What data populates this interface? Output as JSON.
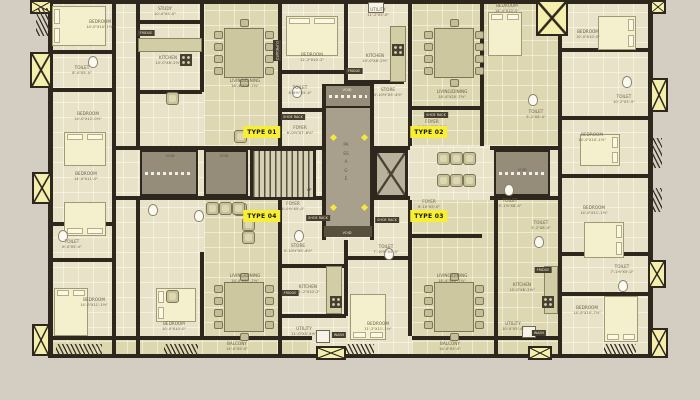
{
  "colors": {
    "background": "#d4cec2",
    "wall": "#2e271e",
    "floor": "#e8e3c8",
    "living_floor": "#ddd8b2",
    "passage": "#a89f8c",
    "void": "#958c7a",
    "highlight_label": "#f7ef35",
    "window_fill": "#f5efad",
    "furniture": "#c7c199",
    "bed": "#f4f0cd",
    "label_text": "#6d6049"
  },
  "icons": {
    "window_cross": "window-x-icon",
    "lift_cross": "lift-x-icon",
    "stairs": "staircase-icon",
    "marker": "diamond-marker-icon"
  },
  "unit_labels": [
    {
      "text": "TYPE 01",
      "x": 262,
      "y": 126
    },
    {
      "text": "TYPE 02",
      "x": 429,
      "y": 126
    },
    {
      "text": "TYPE 03",
      "x": 429,
      "y": 210
    },
    {
      "text": "TYPE 04",
      "x": 262,
      "y": 210
    }
  ],
  "core": {
    "passage": "PASSAGE",
    "lift": "LIFT",
    "up": "UP",
    "void": "VOID"
  },
  "void_labels": [
    {
      "x": 170,
      "y": 154,
      "light": false
    },
    {
      "x": 224,
      "y": 154,
      "light": false
    },
    {
      "x": 522,
      "y": 168,
      "light": false
    },
    {
      "x": 347,
      "y": 88,
      "light": true
    },
    {
      "x": 347,
      "y": 231,
      "light": true
    }
  ],
  "room_labels": [
    {
      "name": "BEDROOM",
      "dims": "14'-0\"X10'-1½\"",
      "x": 100,
      "y": 20
    },
    {
      "name": "TOILET",
      "dims": "8'-0\"X5'-0\"",
      "x": 82,
      "y": 66
    },
    {
      "name": "BEDROOM",
      "dims": "14'-0\"X12'-0½\"",
      "x": 88,
      "y": 112
    },
    {
      "name": "BEDROOM",
      "dims": "14'-0\"X11'-0\"",
      "x": 86,
      "y": 172
    },
    {
      "name": "TOILET",
      "dims": "8'-0\"X5'-0\"",
      "x": 72,
      "y": 240
    },
    {
      "name": "BEDROOM",
      "dims": "14'-0\"X11'-1½\"",
      "x": 94,
      "y": 298
    },
    {
      "name": "BEDROOM",
      "dims": "10'-0\"X10'-0\"",
      "x": 174,
      "y": 322
    },
    {
      "name": "STUDY",
      "dims": "10'-0\"X5'-0\"",
      "x": 165,
      "y": 7
    },
    {
      "name": "KITCHEN",
      "dims": "10'-0\"X8'-2½\"",
      "x": 168,
      "y": 56
    },
    {
      "name": "LIVING/DINING",
      "dims": "18'-4\"X20'-7½\"",
      "x": 245,
      "y": 79
    },
    {
      "name": "BEDROOM",
      "dims": "11'-2\"X10'-2\"",
      "x": 312,
      "y": 53
    },
    {
      "name": "TOILET",
      "dims": "8'-6½\"X5'-4\"",
      "x": 300,
      "y": 86
    },
    {
      "name": "FOYER",
      "dims": "6'-0½\"X7'-6½\"",
      "x": 300,
      "y": 126
    },
    {
      "name": "UTILITY",
      "dims": "11'-2\"X5'-0\"",
      "x": 378,
      "y": 8
    },
    {
      "name": "KITCHEN",
      "dims": "10'-0\"X8'-2½\"",
      "x": 375,
      "y": 54
    },
    {
      "name": "STORE",
      "dims": "4'-10½\"X5'-4½\"",
      "x": 388,
      "y": 88
    },
    {
      "name": "FOYER",
      "dims": "6'-10½\"X7'-6½\"",
      "x": 432,
      "y": 120
    },
    {
      "name": "LIVING/DINING",
      "dims": "18'-4\"X20'-7½\"",
      "x": 452,
      "y": 90
    },
    {
      "name": "BEDROOM",
      "dims": "14'-0\"X10'-0\"",
      "x": 507,
      "y": 4
    },
    {
      "name": "BEDROOM",
      "dims": "10'-0\"X10'-0\"",
      "x": 588,
      "y": 30
    },
    {
      "name": "TOILET",
      "dims": "5'-2\"X8'-0\"",
      "x": 536,
      "y": 110
    },
    {
      "name": "TOILET",
      "dims": "10'-2\"X5'-0\"",
      "x": 624,
      "y": 95
    },
    {
      "name": "BEDROOM",
      "dims": "14'-0\"X10'-1½\"",
      "x": 592,
      "y": 133
    },
    {
      "name": "TOILET",
      "dims": "5'-1½\"X8'-0\"",
      "x": 510,
      "y": 199
    },
    {
      "name": "TOILET",
      "dims": "5'-2\"X8'-0\"",
      "x": 541,
      "y": 221
    },
    {
      "name": "BEDROOM",
      "dims": "14'-0\"X11'-1½\"",
      "x": 594,
      "y": 206
    },
    {
      "name": "FOYER",
      "dims": "6'-0½\"X5'-0\"",
      "x": 293,
      "y": 202
    },
    {
      "name": "STORE",
      "dims": "4'-10½\"X5'-4½\"",
      "x": 298,
      "y": 244
    },
    {
      "name": "FOYER",
      "dims": "6'-10\"X5'-0\"",
      "x": 429,
      "y": 200
    },
    {
      "name": "TOILET",
      "dims": "7'-10½\"X5'-0\"",
      "x": 386,
      "y": 245
    },
    {
      "name": "KITCHEN",
      "dims": "11'-2\"X10'-2\"",
      "x": 308,
      "y": 285
    },
    {
      "name": "UTILITY",
      "dims": "11'-0\"X5'-4½\"",
      "x": 304,
      "y": 327
    },
    {
      "name": "BEDROOM",
      "dims": "11'-2\"X11'-1½\"",
      "x": 378,
      "y": 322
    },
    {
      "name": "LIVING/DINING",
      "dims": "18'-4\"X20'-7½\"",
      "x": 245,
      "y": 274
    },
    {
      "name": "BALCONY",
      "dims": "14'-0\"X5'-0\"",
      "x": 237,
      "y": 342
    },
    {
      "name": "BALCONY",
      "dims": "14'-0\"X5'-0\"",
      "x": 450,
      "y": 342
    },
    {
      "name": "KITCHEN",
      "dims": "10'-0\"X8'-2½\"",
      "x": 522,
      "y": 283
    },
    {
      "name": "UTILITY",
      "dims": "10'-0\"X5'-4\"",
      "x": 513,
      "y": 322
    },
    {
      "name": "TOILET",
      "dims": "7'-1½\"X5'-0\"",
      "x": 622,
      "y": 265
    },
    {
      "name": "BEDROOM",
      "dims": "14'-0\"X10'-7½\"",
      "x": 587,
      "y": 306
    },
    {
      "name": "LIVING/DINING",
      "dims": "18'-4\"X20'-7½\"",
      "x": 452,
      "y": 274
    }
  ],
  "service_tags": [
    {
      "text": "FRIDGE",
      "x": 146,
      "y": 30,
      "vert": false
    },
    {
      "text": "CUPBOARD",
      "x": 277,
      "y": 40,
      "vert": true
    },
    {
      "text": "FRIDGE",
      "x": 354,
      "y": 68,
      "vert": false
    },
    {
      "text": "SHOE RACK",
      "x": 293,
      "y": 114,
      "vert": false
    },
    {
      "text": "SHOE RACK",
      "x": 436,
      "y": 112,
      "vert": false
    },
    {
      "text": "SHOE RACK",
      "x": 318,
      "y": 215,
      "vert": false
    },
    {
      "text": "SHOE RACK",
      "x": 387,
      "y": 217,
      "vert": false
    },
    {
      "text": "FRIDGE",
      "x": 290,
      "y": 290,
      "vert": false
    },
    {
      "text": "FRIDGE",
      "x": 543,
      "y": 267,
      "vert": false
    },
    {
      "text": "WASH",
      "x": 539,
      "y": 330,
      "vert": false
    },
    {
      "text": "WASH",
      "x": 339,
      "y": 332,
      "vert": false
    }
  ]
}
